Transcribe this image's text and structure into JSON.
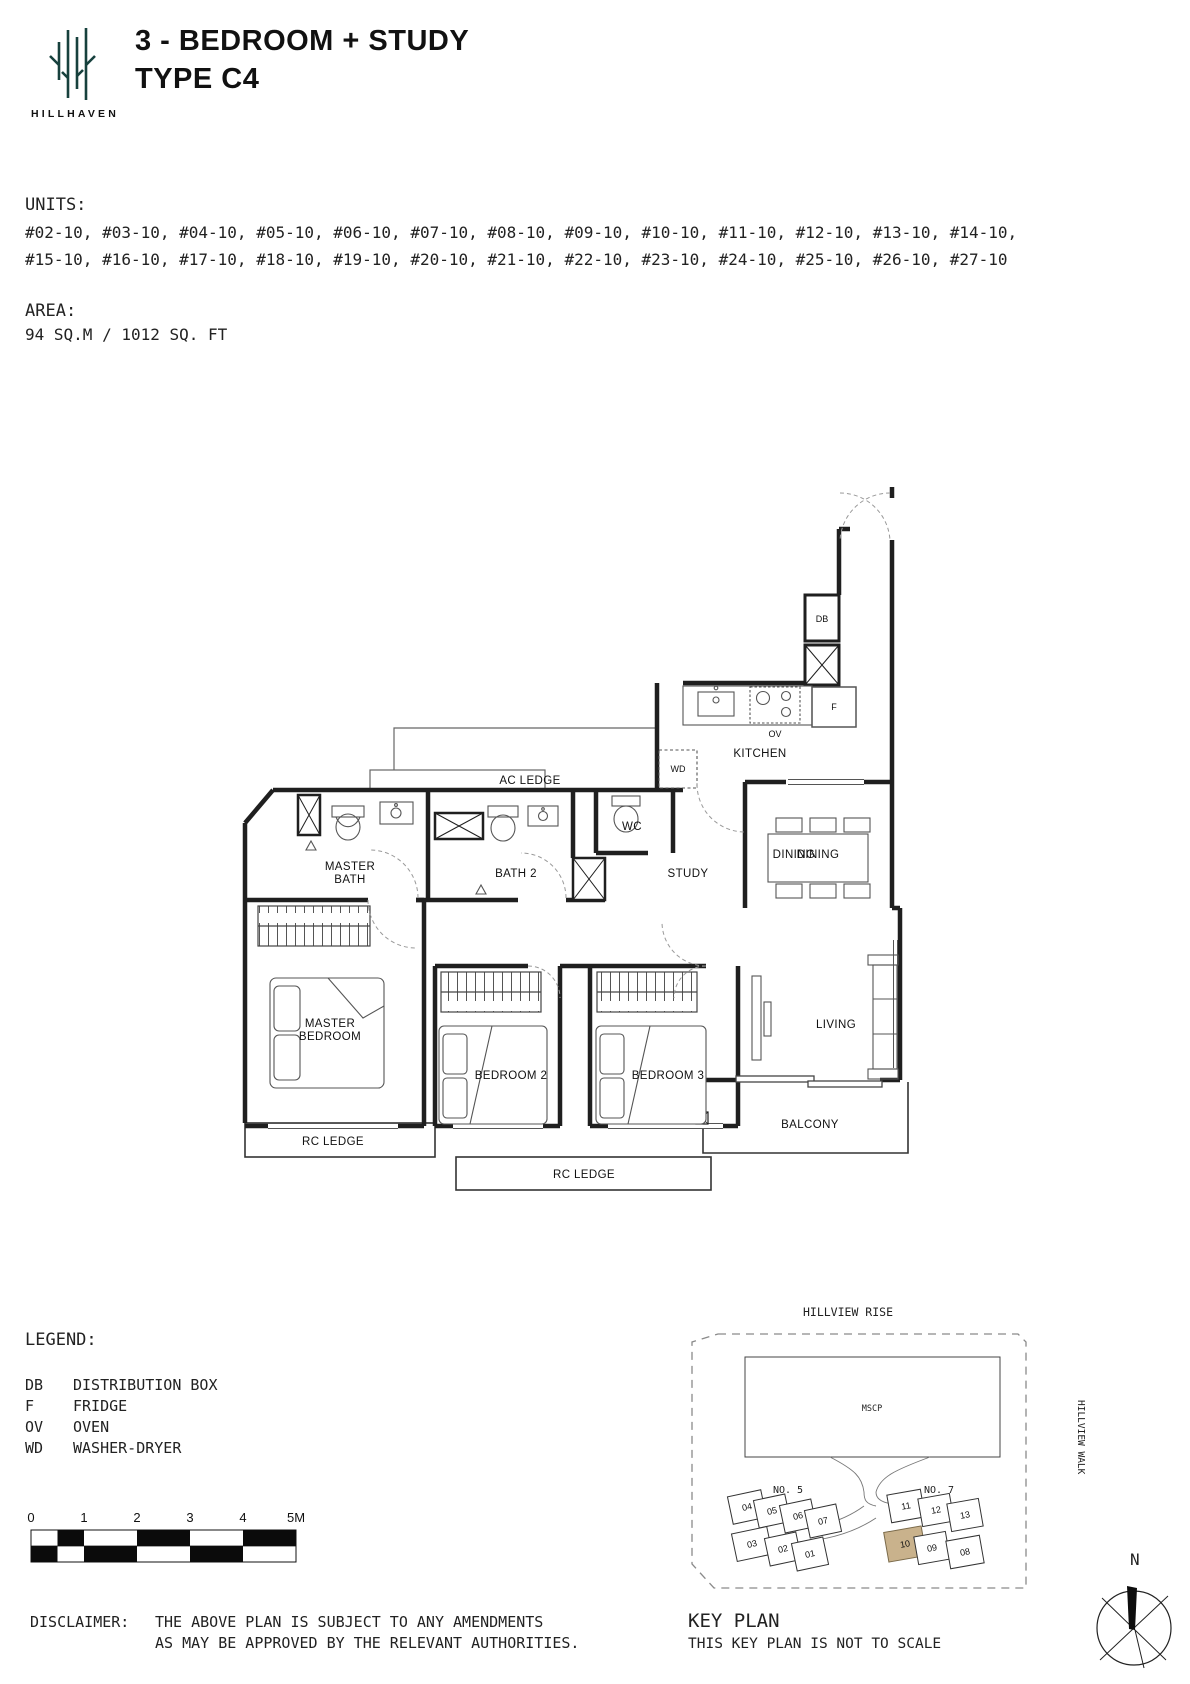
{
  "header": {
    "logo_text": "HILLHAVEN",
    "title_line1": "3 - BEDROOM + STUDY",
    "title_line2": "TYPE C4"
  },
  "units": {
    "label": "UNITS:",
    "line1": "#02-10, #03-10, #04-10, #05-10, #06-10, #07-10, #08-10, #09-10, #10-10, #11-10, #12-10, #13-10, #14-10,",
    "line2": "#15-10, #16-10, #17-10, #18-10, #19-10, #20-10, #21-10, #22-10, #23-10, #24-10, #25-10, #26-10, #27-10"
  },
  "area": {
    "label": "AREA:",
    "value": "94 SQ.M / 1012 SQ. FT"
  },
  "plan": {
    "rooms": {
      "ac_ledge": "AC LEDGE",
      "master_bath_1": "MASTER",
      "master_bath_2": "BATH",
      "bath2": "BATH 2",
      "wc": "WC",
      "study": "STUDY",
      "kitchen": "KITCHEN",
      "dining": "DINING",
      "master_bedroom_1": "MASTER",
      "master_bedroom_2": "BEDROOM",
      "bedroom2": "BEDROOM 2",
      "bedroom3": "BEDROOM 3",
      "living": "LIVING",
      "balcony": "BALCONY",
      "rc_ledge_left": "RC LEDGE",
      "rc_ledge_bottom": "RC LEDGE"
    },
    "fixtures": {
      "db": "DB",
      "f": "F",
      "ov": "OV",
      "wd": "WD"
    }
  },
  "legend": {
    "label": "LEGEND:",
    "items": [
      {
        "abbr": "DB",
        "desc": "DISTRIBUTION BOX"
      },
      {
        "abbr": "F",
        "desc": "FRIDGE"
      },
      {
        "abbr": "OV",
        "desc": "OVEN"
      },
      {
        "abbr": "WD",
        "desc": "WASHER-DRYER"
      }
    ]
  },
  "scale_bar": {
    "ticks": [
      "0",
      "1",
      "2",
      "3",
      "4",
      "5M"
    ]
  },
  "key_plan": {
    "title": "KEY PLAN",
    "note": "THIS KEY PLAN IS NOT TO SCALE",
    "road_top": "HILLVIEW RISE",
    "road_right": "HILLVIEW WALK",
    "mscp": "MSCP",
    "block5": "NO. 5",
    "block7": "NO. 7",
    "units_no5": [
      "04",
      "05",
      "06",
      "07",
      "03",
      "02",
      "01"
    ],
    "units_no7": [
      "11",
      "12",
      "13",
      "10",
      "09",
      "08"
    ],
    "highlighted_unit": "10",
    "highlight_color": "#c9b28c"
  },
  "compass": {
    "label": "N"
  },
  "disclaimer": {
    "label": "DISCLAIMER:",
    "line1": "THE ABOVE PLAN IS SUBJECT TO ANY AMENDMENTS",
    "line2": "AS MAY BE APPROVED BY THE RELEVANT AUTHORITIES."
  },
  "colors": {
    "logo": "#17413d",
    "walls": "#1f1f1f",
    "keyplan_highlight": "#c9b28c"
  }
}
